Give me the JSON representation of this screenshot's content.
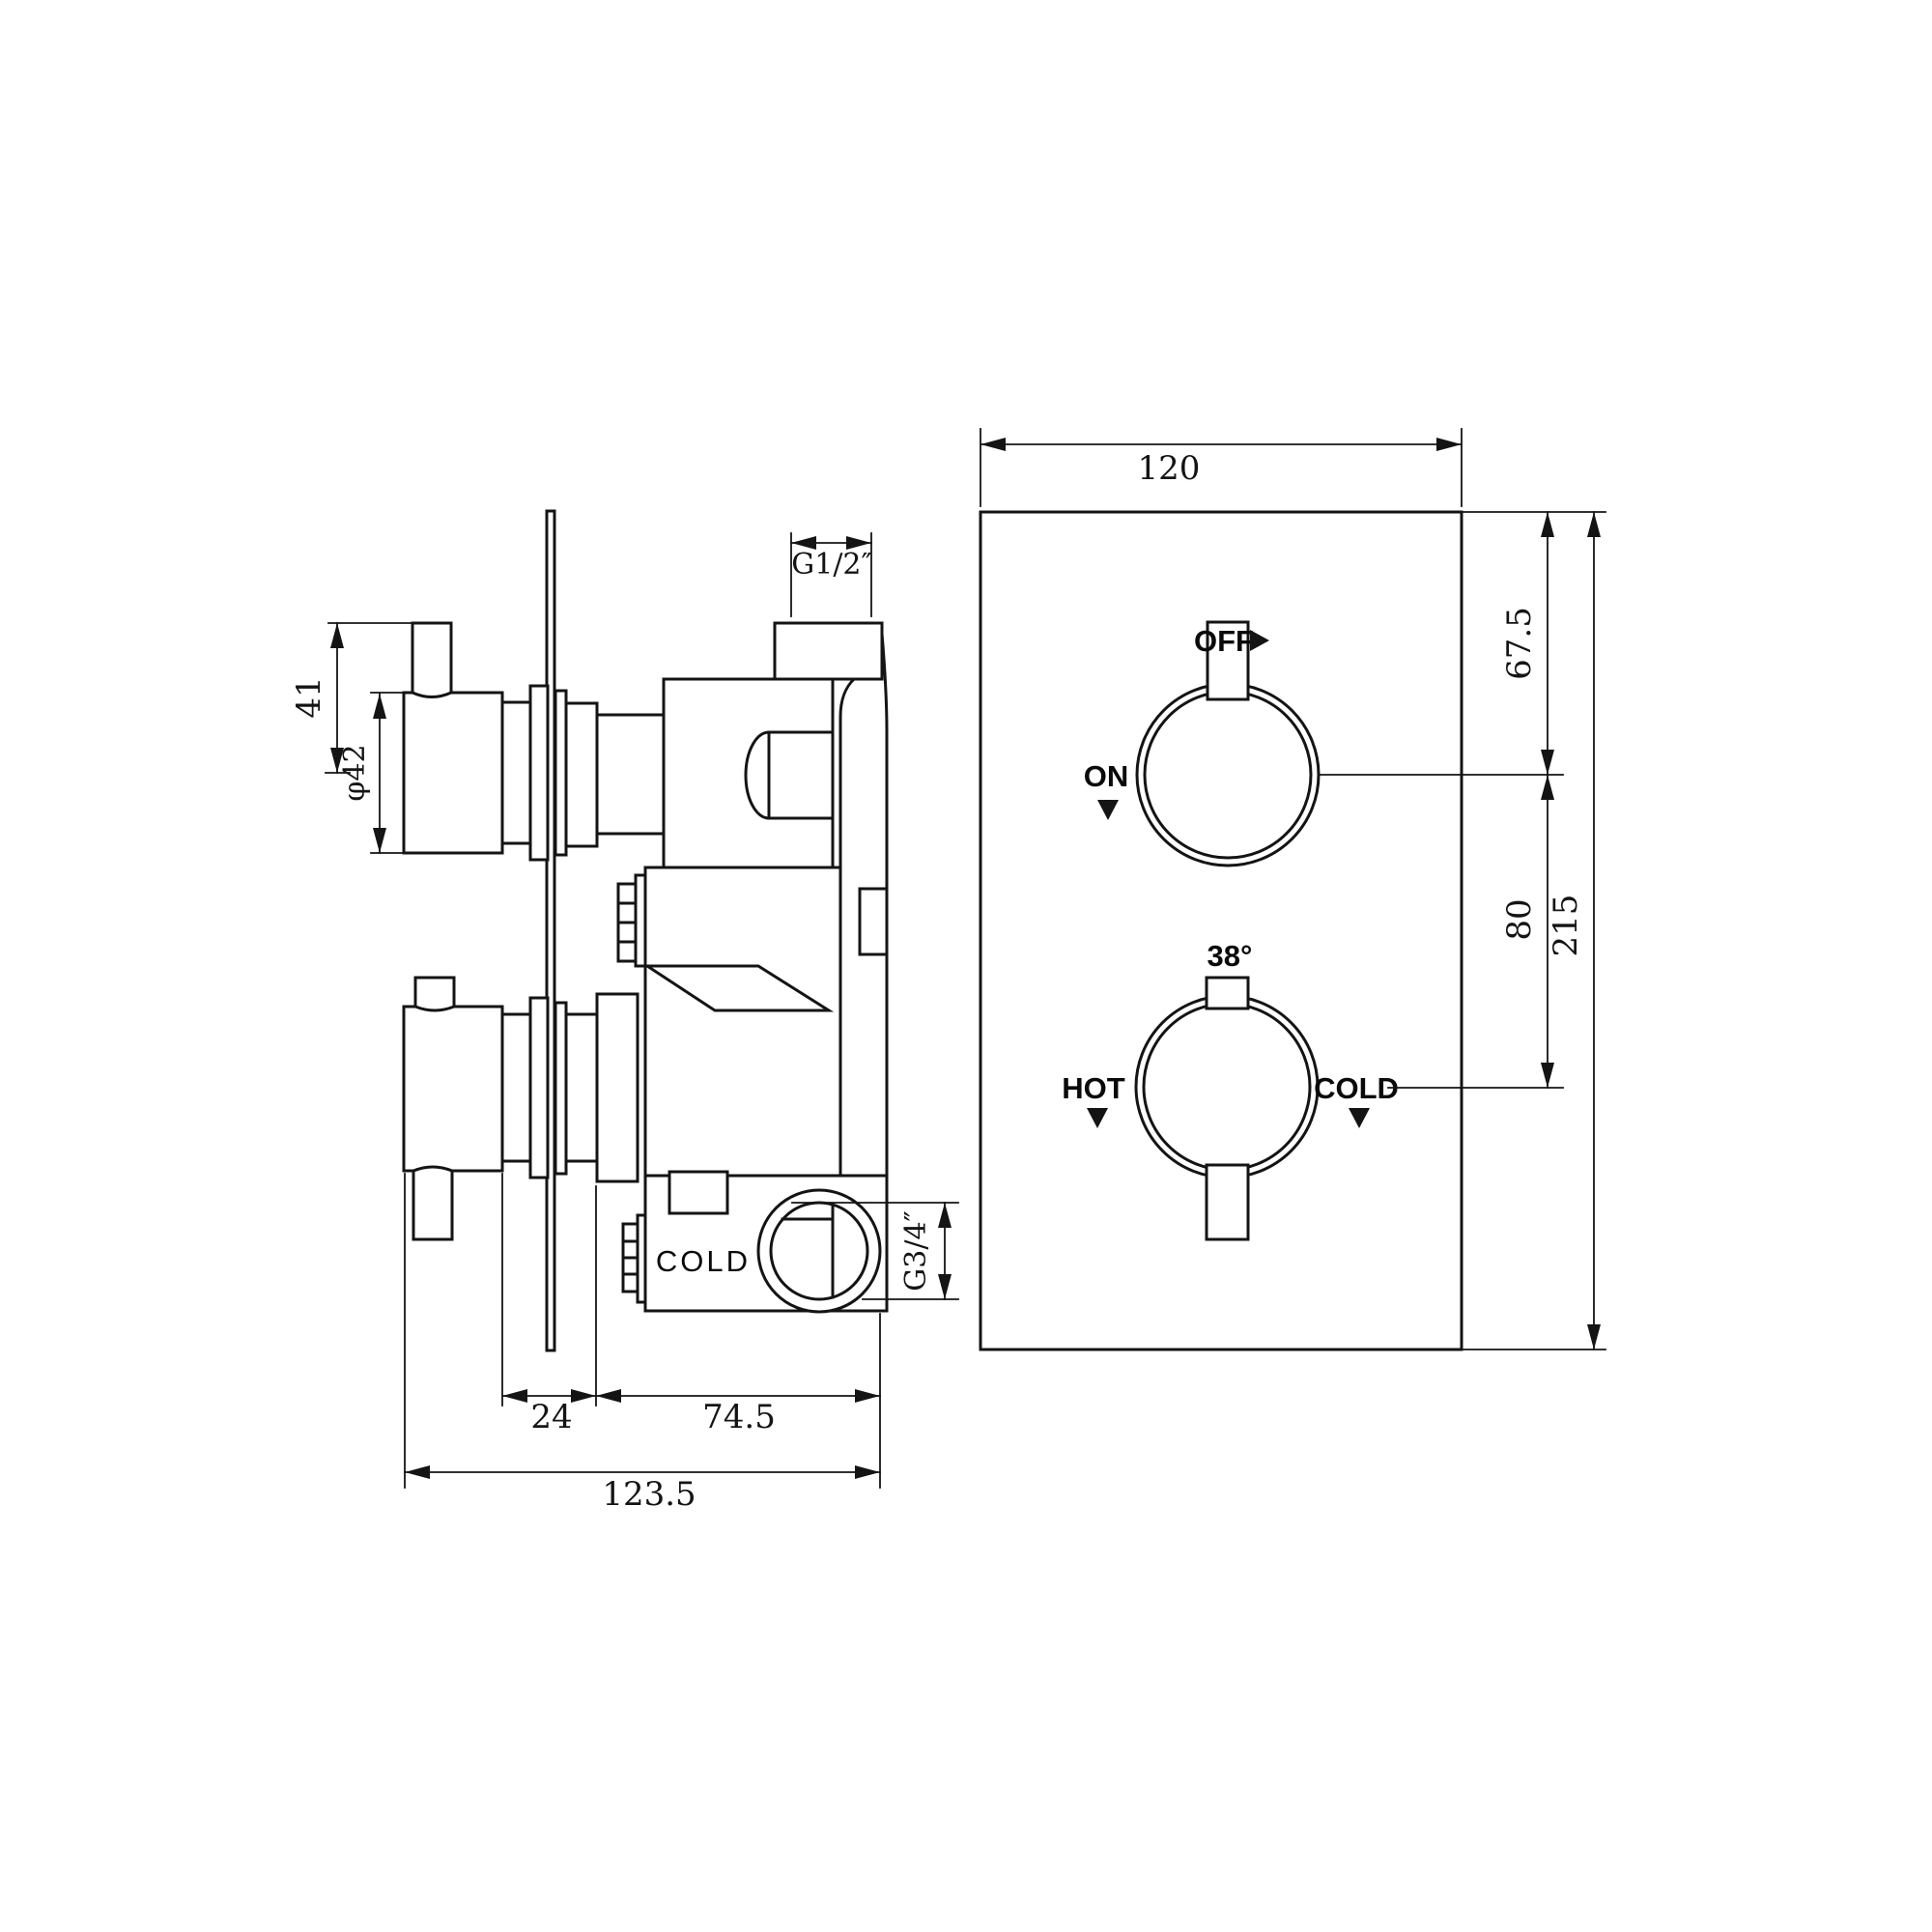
{
  "drawing": {
    "background": "#ffffff",
    "stroke_color": "#141414",
    "type": "thermostatic-shower-valve-technical-drawing",
    "side_view": {
      "labels": {
        "cold_port": "COLD"
      },
      "dimensions": {
        "handle_height": "41",
        "knob_diameter": "φ42",
        "top_outlet_thread": "G1/2″",
        "cold_inlet_thread": "G3/4″",
        "plate_offset": "24",
        "body_depth": "74.5",
        "total_depth": "123.5"
      }
    },
    "front_view": {
      "labels": {
        "off": "OFF",
        "on": "ON",
        "hot": "HOT",
        "cold": "COLD",
        "temperature": "38°"
      },
      "icons": {
        "off_pointer": "right-arrow",
        "on_pointer": "down-arrow",
        "hot_pointer": "down-arrow",
        "cold_pointer": "down-arrow"
      },
      "dimensions": {
        "plate_width": "120",
        "top_knob_offset": "67.5",
        "knob_spacing": "80",
        "plate_height": "215"
      }
    }
  }
}
